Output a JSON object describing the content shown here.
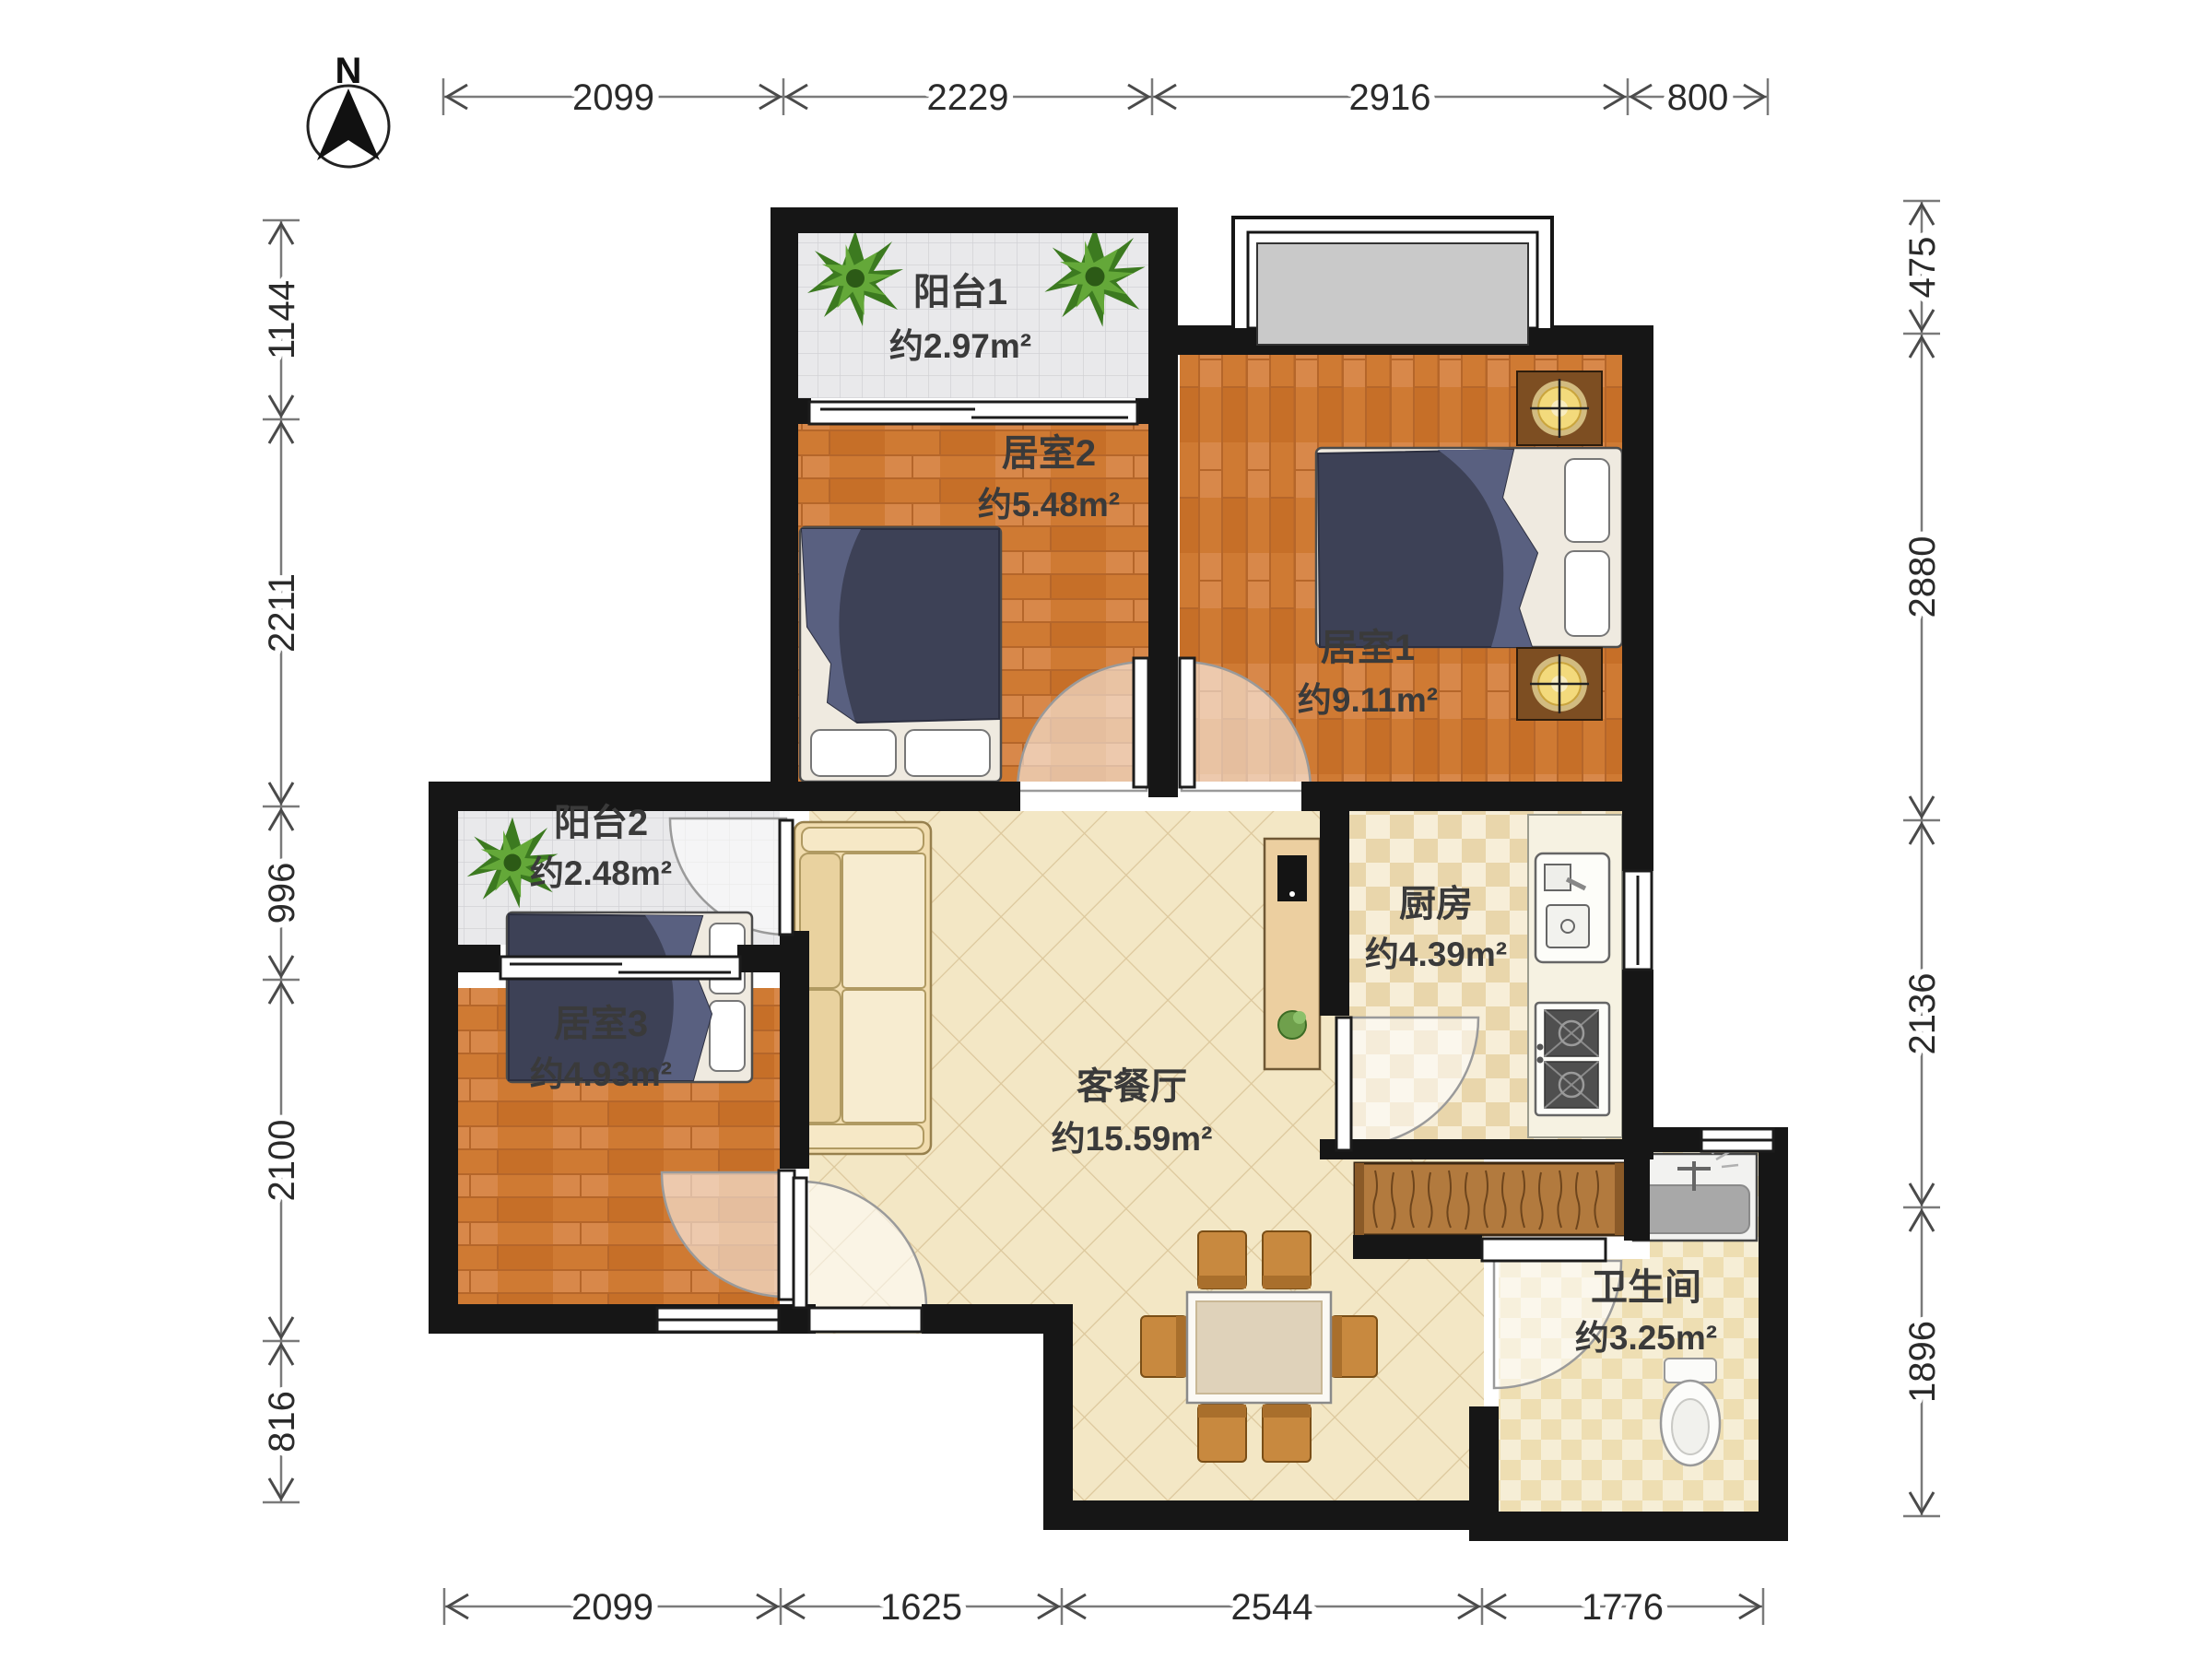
{
  "compass": {
    "label": "N"
  },
  "rooms": [
    {
      "id": "balcony1",
      "name": "阳台1",
      "area": "约2.97m²"
    },
    {
      "id": "bedroom2",
      "name": "居室2",
      "area": "约5.48m²"
    },
    {
      "id": "bedroom1",
      "name": "居室1",
      "area": "约9.11m²"
    },
    {
      "id": "balcony2",
      "name": "阳台2",
      "area": "约2.48m²"
    },
    {
      "id": "bedroom3",
      "name": "居室3",
      "area": "约4.93m²"
    },
    {
      "id": "living",
      "name": "客餐厅",
      "area": "约15.59m²"
    },
    {
      "id": "kitchen",
      "name": "厨房",
      "area": "约4.39m²"
    },
    {
      "id": "bathroom",
      "name": "卫生间",
      "area": "约3.25m²"
    }
  ],
  "dimensions": {
    "top": [
      "2099",
      "2229",
      "2916",
      "800"
    ],
    "bottom": [
      "2099",
      "1625",
      "2544",
      "1776"
    ],
    "left": [
      "1144",
      "2211",
      "996",
      "2100",
      "816"
    ],
    "right": [
      "475",
      "2880",
      "2136",
      "1896"
    ]
  },
  "colors": {
    "wall": "#161616",
    "wood_floor": "#cf7a33",
    "balcony_tile": "#e9e9eb",
    "living_tile": "#f3e7c5",
    "kitchen_tile": "#e9d6ab",
    "duvet_navy": "#3d4156",
    "furniture_brown": "#b27a3e",
    "label_text": "#3a3a3a",
    "dimension_text": "#2a2a2a"
  }
}
